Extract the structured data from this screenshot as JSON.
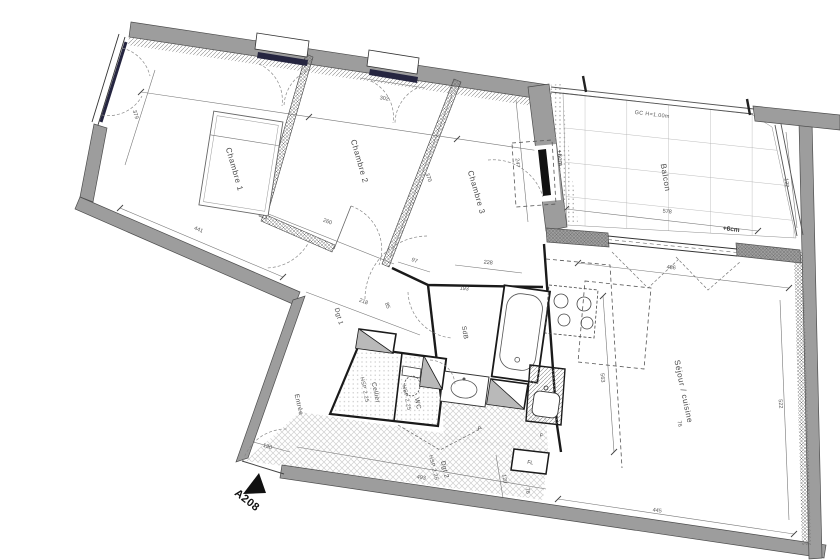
{
  "plan": {
    "unit": "A208",
    "rooms": {
      "chambre1": "Chambre 1",
      "chambre2": "Chambre 2",
      "chambre3": "Chambre 3",
      "balcon": "Balcon",
      "sejour": "Séjour / cuisine",
      "entree": "Entrée",
      "cellier": "Cellier",
      "wc": "WC",
      "sdb": "SdB",
      "dgt1": "Dgt 1",
      "dgt2": "Dgt 2",
      "hsp": "HSP 2.25"
    },
    "annotations": {
      "guardrail": "GC  H=1.00m",
      "level_balcony_door": "+6cm",
      "level_balcony": "+6cm",
      "p": "P",
      "f": "F",
      "washer": "FL"
    },
    "dims": {
      "ch1_w": "441",
      "ch1_d": "379",
      "ch2_w": "260",
      "ch2_d": "370",
      "win2": "302",
      "ch3_d": "247",
      "dgt1_l": "218",
      "dgt1_w": "97",
      "ch1_door": "85",
      "sdb_w": "228",
      "sdb_d": "193",
      "sej_top": "486",
      "sej_left": "563",
      "sej_right": "522",
      "sej_bottom": "445",
      "balc_w": "578",
      "balc_d": "122",
      "ent": "130",
      "dgt2_l": "493",
      "dgt2_w": "120",
      "wm": "76"
    },
    "colors": {
      "wall": "#9d9d9d",
      "wall_edge": "#4d4d4d",
      "line": "#555555",
      "fixture": "#222222"
    }
  }
}
